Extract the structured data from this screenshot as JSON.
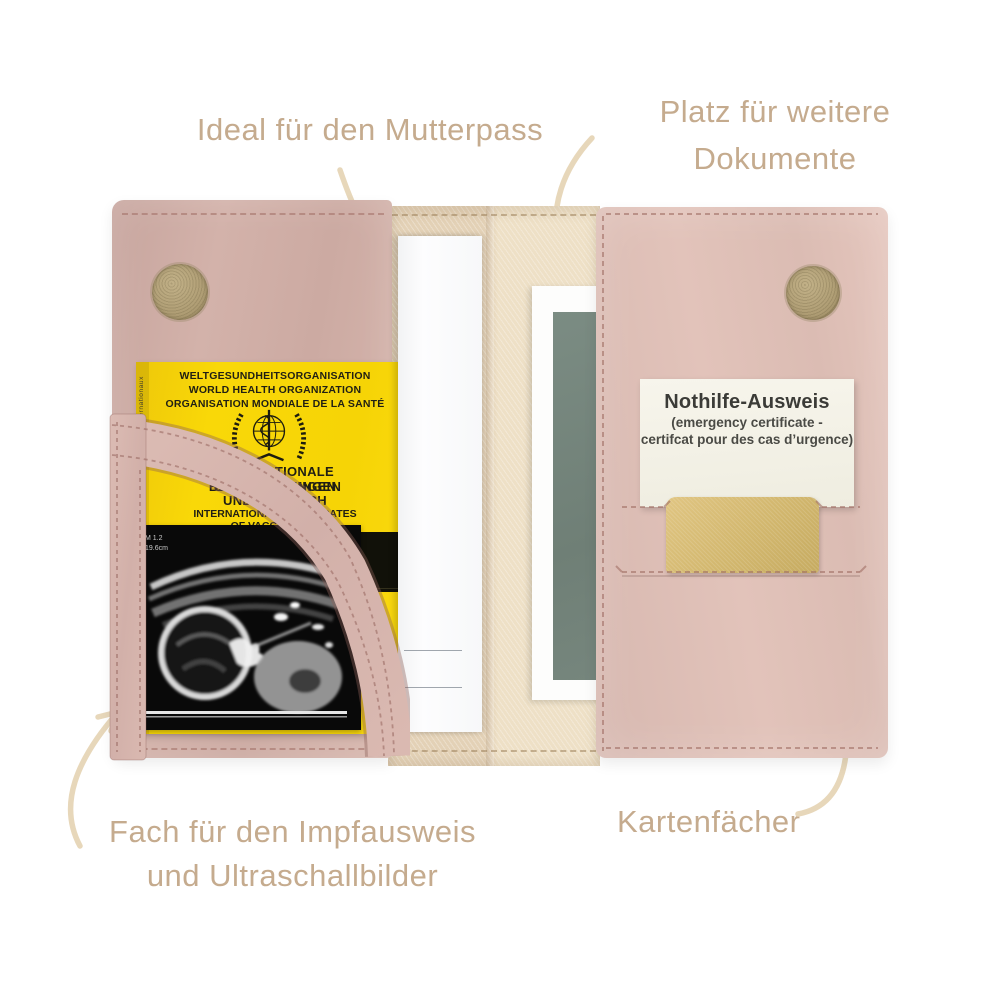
{
  "annotations": {
    "mutterpass": "Ideal für den Mutterpass",
    "dokumente_line1": "Platz für weitere",
    "dokumente_line2": "Dokumente",
    "impfausweis_line1": "Fach für den Impfausweis",
    "impfausweis_line2": "und Ultraschallbilder",
    "kartenfaecher": "Kartenfächer"
  },
  "vaccination_book": {
    "org_line1": "WELTGESUNDHEITSORGANISATION",
    "org_line2": "WORLD HEALTH ORGANIZATION",
    "org_line3": "ORGANISATION MONDIALE DE LA SANTÉ",
    "title_line1": "INTERNATIONALE BESCHEINIGUNGEN",
    "title_line2": "ÜBER IMPFUNGEN",
    "title_line3": "UND IMPFBUCH",
    "subtitle_line1": "INTERNATIONAL CERTIFICATES",
    "subtitle_line2": "OF VACCINATION",
    "subtitle_line3": "CERTIFICATS INTERNATIONAUX",
    "spine_text": "Regulations / Règlements Sanitaires Internationaux"
  },
  "emergency_card": {
    "title": "Nothilfe-Ausweis",
    "subtitle_line1": "(emergency certificate -",
    "subtitle_line2": "certifcat pour des cas d’urgence)"
  },
  "ultrasound": {
    "meta_line1": "M 1.2",
    "meta_line2": "19.6cm"
  },
  "colors": {
    "leather_pink_left": "#d3b2aa",
    "leather_pink_right": "#dfc0b8",
    "interior_fabric": "#e7d6bd",
    "vaccination_book_yellow": "#f8d606",
    "emergency_card_bg": "#f5f3e8",
    "gold_card": "#d9be74",
    "document_green": "#75867d",
    "velcro_tan": "#b5a37b",
    "annotation_text": "#c5ab8e",
    "arrow_cream": "#e7d7ba"
  }
}
